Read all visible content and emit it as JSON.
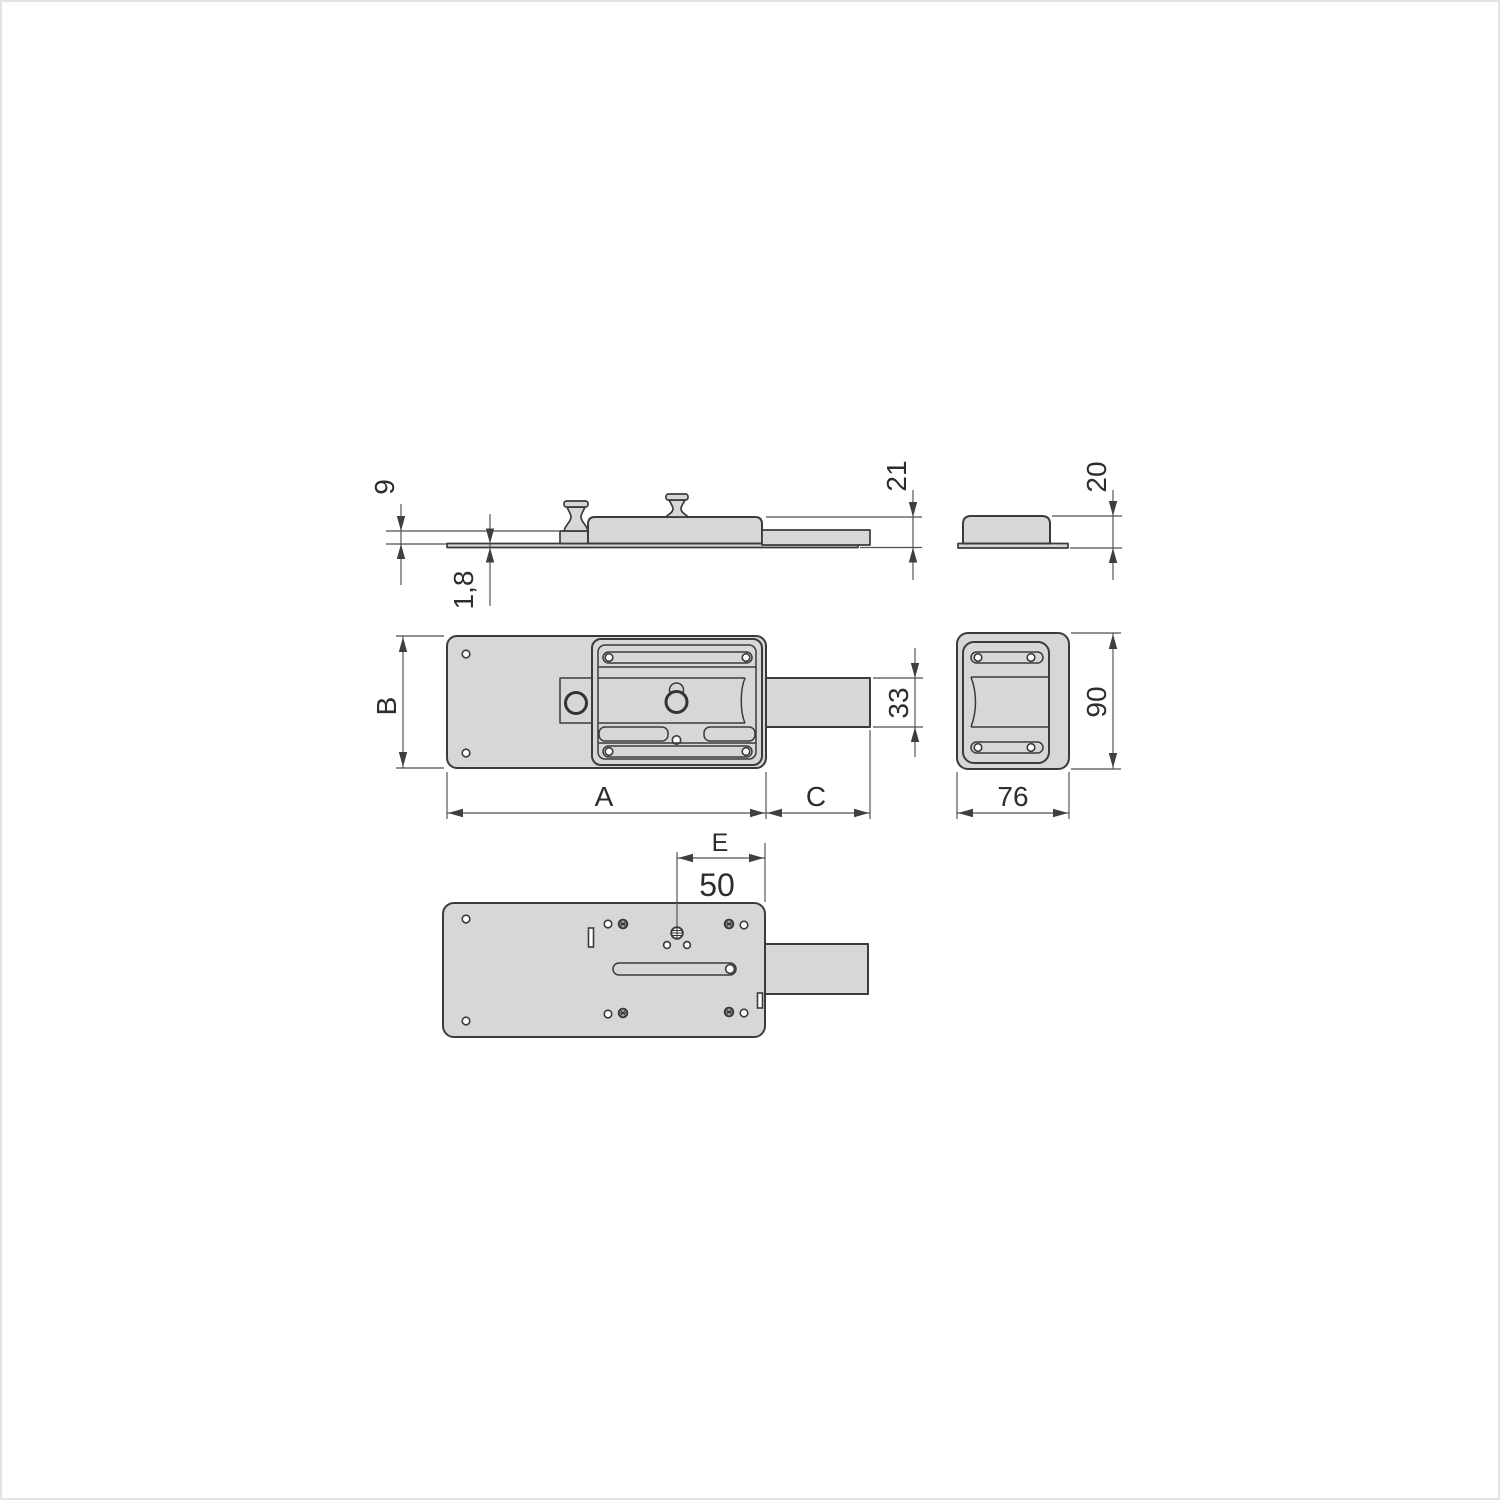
{
  "drawing": {
    "type": "technical-dimension-drawing",
    "subject": "floor-mounted garage door lock (plan, side and end views)",
    "colors": {
      "background": "#ffffff",
      "part_fill": "#d7d7d7",
      "outline": "#3b3b3b",
      "dimension_lines": "#4f4f4f",
      "text": "#2d2d2d"
    },
    "dimensions": {
      "step_height": "9",
      "plate_thickness": "1,8",
      "body_height": "21",
      "case_height": "20",
      "plate_height": "B",
      "bolt_height": "33",
      "end_height": "90",
      "plate_length": "A",
      "bolt_throw": "C",
      "end_width": "76",
      "key_distance": "E",
      "key_distance_value": "50"
    }
  }
}
